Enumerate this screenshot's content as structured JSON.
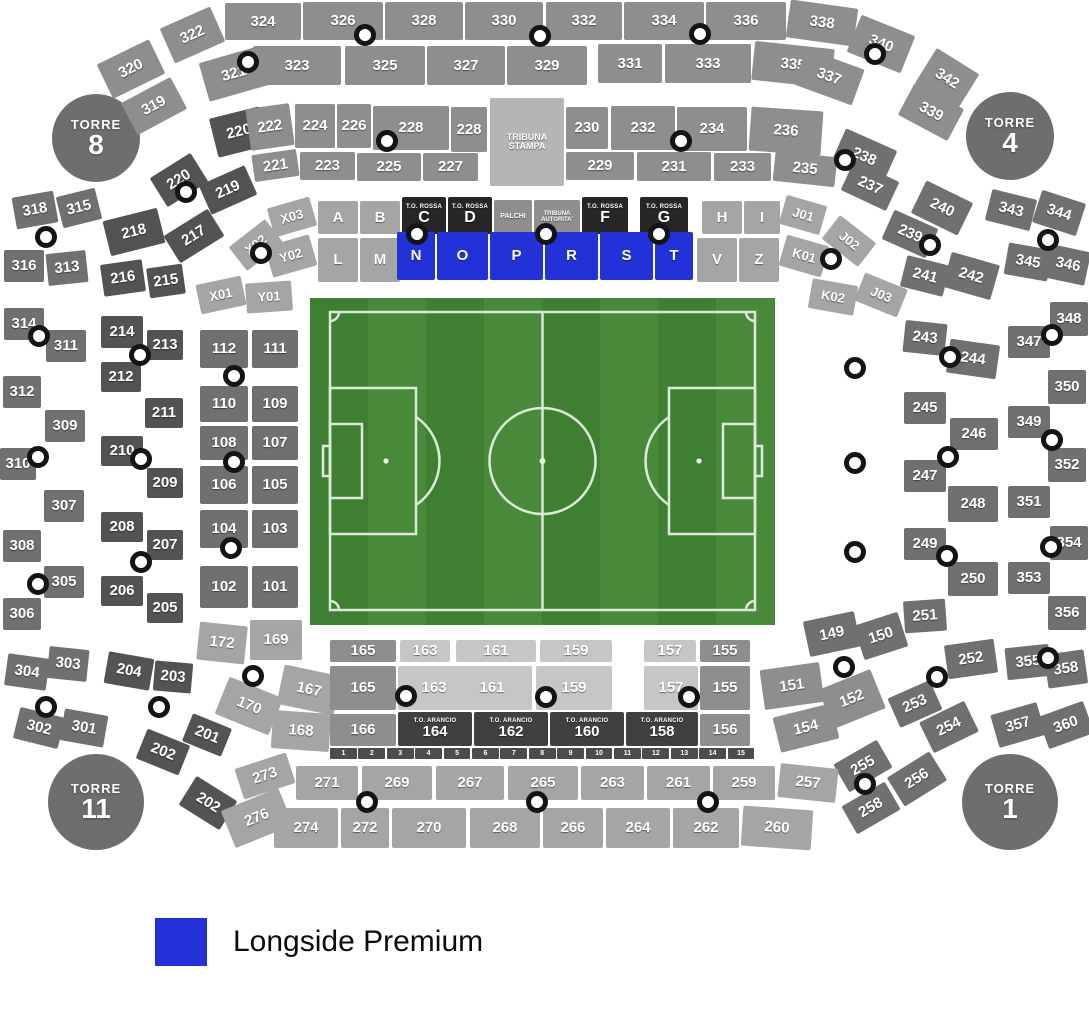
{
  "legend": {
    "label": "Longside Premium",
    "color": "#2232d8"
  },
  "towers": [
    {
      "word": "TORRE",
      "num": "8"
    },
    {
      "word": "TORRE",
      "num": "4"
    },
    {
      "word": "TORRE",
      "num": "11"
    },
    {
      "word": "TORRE",
      "num": "1"
    }
  ],
  "colors": {
    "a": "#8e8e8e",
    "b": "#707070",
    "c": "#535353",
    "d": "#a5a5a5",
    "e": "#c6c6c6",
    "f": "#262626",
    "g": "#404040",
    "ts": "#b5b5b5",
    "blue": "#2232d8"
  },
  "sections": [
    [
      "322",
      165,
      16,
      55,
      38,
      "a",
      -24
    ],
    [
      "324",
      225,
      3,
      76,
      37
    ],
    [
      "326",
      303,
      2,
      80,
      38
    ],
    [
      "328",
      385,
      2,
      78,
      38
    ],
    [
      "330",
      465,
      2,
      78,
      38
    ],
    [
      "332",
      546,
      2,
      76,
      38
    ],
    [
      "334",
      624,
      2,
      80,
      38
    ],
    [
      "336",
      706,
      2,
      80,
      38
    ],
    [
      "338",
      788,
      4,
      68,
      38,
      "a",
      8
    ],
    [
      "340",
      852,
      24,
      58,
      40,
      "a",
      22
    ],
    [
      "320",
      102,
      50,
      58,
      38,
      "a",
      -26
    ],
    [
      "321",
      203,
      54,
      62,
      40,
      "a",
      -16
    ],
    [
      "323",
      253,
      46,
      88,
      39
    ],
    [
      "325",
      345,
      46,
      80,
      39
    ],
    [
      "327",
      427,
      46,
      78,
      39
    ],
    [
      "329",
      507,
      46,
      80,
      39
    ],
    [
      "331",
      598,
      44,
      64,
      39
    ],
    [
      "333",
      665,
      44,
      86,
      39
    ],
    [
      "335",
      753,
      45,
      80,
      39,
      "a",
      6
    ],
    [
      "337",
      798,
      58,
      62,
      38,
      "a",
      20
    ],
    [
      "342",
      922,
      58,
      50,
      42,
      "a",
      32
    ],
    [
      "319",
      126,
      88,
      56,
      36,
      "a",
      -28
    ],
    [
      "339",
      903,
      94,
      56,
      36,
      "a",
      28
    ],
    [
      "220",
      213,
      112,
      52,
      40,
      "c",
      -14
    ],
    [
      "222",
      248,
      106,
      44,
      42,
      "a",
      -8
    ],
    [
      "224",
      295,
      104,
      40,
      44
    ],
    [
      "226",
      337,
      104,
      34,
      44
    ],
    [
      "228",
      373,
      106,
      76,
      44
    ],
    [
      "228",
      451,
      107,
      36,
      45
    ],
    [
      "TRIBUNA STAMPA",
      490,
      98,
      74,
      88,
      "ts",
      0,
      9
    ],
    [
      "230",
      566,
      107,
      42,
      42
    ],
    [
      "232",
      611,
      106,
      64,
      44
    ],
    [
      "234",
      677,
      107,
      70,
      44
    ],
    [
      "236",
      750,
      109,
      72,
      44,
      "a",
      4
    ],
    [
      "238",
      836,
      138,
      56,
      38,
      "b",
      24
    ],
    [
      "221",
      253,
      152,
      45,
      27,
      "a",
      -8
    ],
    [
      "223",
      300,
      152,
      55,
      28
    ],
    [
      "225",
      357,
      153,
      64,
      28
    ],
    [
      "227",
      423,
      153,
      55,
      28
    ],
    [
      "229",
      566,
      152,
      68,
      28
    ],
    [
      "231",
      637,
      152,
      74,
      29
    ],
    [
      "233",
      714,
      153,
      57,
      28
    ],
    [
      "235",
      774,
      154,
      62,
      30,
      "a",
      6
    ],
    [
      "237",
      845,
      170,
      50,
      32,
      "b",
      25
    ],
    [
      "220",
      155,
      163,
      48,
      34,
      "c",
      -32
    ],
    [
      "219",
      203,
      174,
      50,
      32,
      "c",
      -24
    ],
    [
      "217",
      168,
      220,
      52,
      32,
      "c",
      -32
    ],
    [
      "218",
      106,
      214,
      56,
      36,
      "c",
      -14
    ],
    [
      "216",
      102,
      262,
      42,
      32,
      "c",
      -8
    ],
    [
      "215",
      148,
      266,
      36,
      30,
      "c",
      -8
    ],
    [
      "214",
      101,
      316,
      42,
      32,
      "c"
    ],
    [
      "213",
      147,
      330,
      36,
      30,
      "c"
    ],
    [
      "212",
      101,
      362,
      40,
      30,
      "c"
    ],
    [
      "211",
      145,
      398,
      38,
      30,
      "c"
    ],
    [
      "210",
      101,
      436,
      42,
      30,
      "c"
    ],
    [
      "209",
      147,
      468,
      36,
      30,
      "c"
    ],
    [
      "208",
      101,
      512,
      42,
      30,
      "c"
    ],
    [
      "207",
      147,
      530,
      36,
      30,
      "c"
    ],
    [
      "206",
      101,
      576,
      42,
      30,
      "c"
    ],
    [
      "205",
      147,
      593,
      36,
      30,
      "c"
    ],
    [
      "204",
      106,
      655,
      46,
      32,
      "c",
      10
    ],
    [
      "203",
      154,
      662,
      38,
      30,
      "c",
      5
    ],
    [
      "202",
      140,
      736,
      46,
      32,
      "c",
      22
    ],
    [
      "201",
      186,
      720,
      42,
      30,
      "c",
      22
    ],
    [
      "202",
      184,
      786,
      48,
      34,
      "c",
      32
    ],
    [
      "318",
      14,
      194,
      42,
      32,
      "b",
      -10
    ],
    [
      "315",
      59,
      192,
      40,
      32,
      "b",
      -14
    ],
    [
      "316",
      4,
      250,
      40,
      32,
      "b"
    ],
    [
      "313",
      47,
      252,
      40,
      32,
      "b",
      -6
    ],
    [
      "314",
      4,
      308,
      40,
      32,
      "b"
    ],
    [
      "311",
      46,
      330,
      40,
      32,
      "b"
    ],
    [
      "312",
      3,
      376,
      38,
      32,
      "b"
    ],
    [
      "309",
      45,
      410,
      40,
      32,
      "b"
    ],
    [
      "310",
      0,
      448,
      36,
      32,
      "b"
    ],
    [
      "307",
      44,
      490,
      40,
      32,
      "b"
    ],
    [
      "308",
      3,
      530,
      38,
      32,
      "b"
    ],
    [
      "305",
      44,
      566,
      40,
      32,
      "b"
    ],
    [
      "306",
      3,
      598,
      38,
      32,
      "b"
    ],
    [
      "303",
      48,
      648,
      40,
      32,
      "b",
      6
    ],
    [
      "304",
      6,
      656,
      42,
      32,
      "b",
      8
    ],
    [
      "302",
      16,
      712,
      46,
      32,
      "b",
      14
    ],
    [
      "301",
      62,
      712,
      44,
      32,
      "b",
      10
    ],
    [
      "112",
      200,
      330,
      48,
      38,
      "b"
    ],
    [
      "111",
      252,
      330,
      46,
      38,
      "b"
    ],
    [
      "110",
      200,
      386,
      48,
      36,
      "b"
    ],
    [
      "109",
      252,
      386,
      46,
      36,
      "b"
    ],
    [
      "108",
      200,
      426,
      48,
      34,
      "b"
    ],
    [
      "107",
      252,
      426,
      46,
      34,
      "b"
    ],
    [
      "106",
      200,
      466,
      48,
      38,
      "b"
    ],
    [
      "105",
      252,
      466,
      46,
      38,
      "b"
    ],
    [
      "104",
      200,
      510,
      48,
      38,
      "b"
    ],
    [
      "103",
      252,
      510,
      46,
      38,
      "b"
    ],
    [
      "102",
      200,
      566,
      48,
      42,
      "b"
    ],
    [
      "101",
      252,
      566,
      46,
      42,
      "b"
    ],
    [
      "172",
      198,
      624,
      48,
      38,
      "d",
      6
    ],
    [
      "169",
      250,
      620,
      52,
      40,
      "d"
    ],
    [
      "170",
      220,
      686,
      58,
      40,
      "d",
      22
    ],
    [
      "167",
      280,
      670,
      58,
      40,
      "d",
      12
    ],
    [
      "168",
      272,
      712,
      58,
      38,
      "d",
      4
    ],
    [
      "X03",
      270,
      202,
      44,
      30,
      "d",
      -16,
      13
    ],
    [
      "A",
      318,
      201,
      40,
      33,
      "d"
    ],
    [
      "B",
      360,
      201,
      40,
      33,
      "d"
    ],
    [
      "C",
      402,
      197,
      44,
      37,
      "f",
      0,
      16,
      "T.O. ROSSA"
    ],
    [
      "D",
      448,
      197,
      44,
      37,
      "f",
      0,
      16,
      "T.O. ROSSA"
    ],
    [
      "PALCHI",
      494,
      200,
      38,
      34,
      "a",
      0,
      7
    ],
    [
      "TRIBUNA AUTORITA'",
      534,
      200,
      46,
      34,
      "a",
      0,
      6
    ],
    [
      "F",
      582,
      197,
      46,
      37,
      "f",
      0,
      16,
      "T.O. ROSSA"
    ],
    [
      "G",
      640,
      197,
      48,
      37,
      "f",
      0,
      16,
      "T.O. ROSSA"
    ],
    [
      "H",
      702,
      201,
      40,
      33,
      "d"
    ],
    [
      "I",
      744,
      201,
      36,
      33,
      "d"
    ],
    [
      "J01",
      782,
      200,
      42,
      30,
      "d",
      16,
      13
    ],
    [
      "Y02",
      268,
      240,
      46,
      32,
      "d",
      -16,
      13
    ],
    [
      "L",
      318,
      238,
      40,
      44,
      "d"
    ],
    [
      "M",
      360,
      238,
      40,
      44,
      "d"
    ],
    [
      "N",
      397,
      232,
      38,
      48,
      "blue"
    ],
    [
      "O",
      437,
      232,
      51,
      48,
      "blue"
    ],
    [
      "P",
      490,
      232,
      53,
      48,
      "blue"
    ],
    [
      "R",
      545,
      232,
      53,
      48,
      "blue"
    ],
    [
      "S",
      600,
      232,
      53,
      48,
      "blue"
    ],
    [
      "T",
      655,
      232,
      38,
      48,
      "blue"
    ],
    [
      "V",
      697,
      238,
      40,
      44,
      "d"
    ],
    [
      "Z",
      739,
      238,
      40,
      44,
      "d"
    ],
    [
      "K01",
      782,
      240,
      44,
      32,
      "d",
      16,
      13
    ],
    [
      "X02",
      233,
      230,
      46,
      30,
      "d",
      -38,
      13
    ],
    [
      "X01",
      198,
      280,
      46,
      30,
      "d",
      -12,
      13
    ],
    [
      "Y01",
      246,
      282,
      46,
      30,
      "d",
      -4,
      13
    ],
    [
      "J02",
      826,
      226,
      46,
      30,
      "d",
      38,
      13
    ],
    [
      "K02",
      810,
      282,
      46,
      30,
      "d",
      10,
      13
    ],
    [
      "J03",
      858,
      280,
      46,
      30,
      "d",
      22,
      13
    ],
    [
      "239",
      886,
      218,
      48,
      32,
      "b",
      24
    ],
    [
      "240",
      916,
      190,
      52,
      36,
      "b",
      26
    ],
    [
      "241",
      903,
      260,
      44,
      32,
      "b",
      14
    ],
    [
      "242",
      946,
      258,
      50,
      36,
      "b",
      16
    ],
    [
      "243",
      904,
      322,
      42,
      32,
      "b",
      6
    ],
    [
      "244",
      948,
      342,
      50,
      34,
      "b",
      8
    ],
    [
      "245",
      904,
      392,
      42,
      32,
      "b"
    ],
    [
      "246",
      950,
      418,
      48,
      32,
      "b"
    ],
    [
      "247",
      904,
      460,
      42,
      32,
      "b"
    ],
    [
      "248",
      948,
      486,
      50,
      36,
      "b"
    ],
    [
      "249",
      904,
      528,
      42,
      32,
      "b"
    ],
    [
      "250",
      948,
      562,
      50,
      34,
      "b"
    ],
    [
      "251",
      904,
      600,
      42,
      32,
      "b",
      -4
    ],
    [
      "252",
      946,
      642,
      50,
      34,
      "b",
      -8
    ],
    [
      "253",
      892,
      688,
      46,
      32,
      "b",
      -24
    ],
    [
      "254",
      924,
      710,
      50,
      34,
      "b",
      -26
    ],
    [
      "255",
      838,
      750,
      50,
      32,
      "b",
      -30
    ],
    [
      "256",
      892,
      762,
      50,
      34,
      "b",
      -32
    ],
    [
      "258",
      846,
      792,
      50,
      32,
      "b",
      -30
    ],
    [
      "343",
      988,
      194,
      46,
      32,
      "b",
      14
    ],
    [
      "344",
      1036,
      196,
      46,
      34,
      "b",
      18
    ],
    [
      "345",
      1006,
      246,
      44,
      32,
      "b",
      10
    ],
    [
      "346",
      1048,
      248,
      40,
      34,
      "b",
      12
    ],
    [
      "348",
      1050,
      302,
      38,
      34,
      "b"
    ],
    [
      "347",
      1008,
      326,
      42,
      32,
      "b"
    ],
    [
      "350",
      1048,
      370,
      38,
      34,
      "b"
    ],
    [
      "349",
      1008,
      406,
      42,
      32,
      "b"
    ],
    [
      "352",
      1048,
      448,
      38,
      34,
      "b"
    ],
    [
      "351",
      1008,
      486,
      42,
      32,
      "b"
    ],
    [
      "354",
      1050,
      526,
      38,
      34,
      "b"
    ],
    [
      "353",
      1008,
      562,
      42,
      32,
      "b"
    ],
    [
      "356",
      1048,
      596,
      38,
      34,
      "b"
    ],
    [
      "355",
      1006,
      646,
      44,
      32,
      "b",
      -6
    ],
    [
      "358",
      1046,
      652,
      40,
      34,
      "b",
      -8
    ],
    [
      "357",
      994,
      708,
      48,
      34,
      "b",
      -16
    ],
    [
      "360",
      1042,
      708,
      48,
      34,
      "b",
      -20
    ],
    [
      "165",
      330,
      640,
      66,
      22,
      "a"
    ],
    [
      "163",
      400,
      640,
      50,
      22,
      "e"
    ],
    [
      "161",
      456,
      640,
      80,
      22,
      "e"
    ],
    [
      "159",
      540,
      640,
      72,
      22,
      "e"
    ],
    [
      "157",
      644,
      640,
      52,
      22,
      "e"
    ],
    [
      "155",
      700,
      640,
      50,
      22,
      "a"
    ],
    [
      "165",
      330,
      666,
      66,
      44,
      "a"
    ],
    [
      "163",
      398,
      666,
      72,
      44,
      "e"
    ],
    [
      "161",
      452,
      666,
      80,
      44,
      "e"
    ],
    [
      "159",
      536,
      666,
      76,
      44,
      "e"
    ],
    [
      "157",
      644,
      666,
      54,
      44,
      "e"
    ],
    [
      "155",
      700,
      666,
      50,
      44,
      "a"
    ],
    [
      "166",
      330,
      714,
      66,
      32,
      "a"
    ],
    [
      "164",
      398,
      712,
      74,
      34,
      "g",
      0,
      15,
      "T.O. ARANCIO"
    ],
    [
      "162",
      474,
      712,
      74,
      34,
      "g",
      0,
      15,
      "T.O. ARANCIO"
    ],
    [
      "160",
      550,
      712,
      74,
      34,
      "g",
      0,
      15,
      "T.O. ARANCIO"
    ],
    [
      "158",
      626,
      712,
      72,
      34,
      "g",
      0,
      15,
      "T.O. ARANCIO"
    ],
    [
      "156",
      700,
      714,
      50,
      32,
      "a"
    ],
    [
      "151",
      762,
      666,
      60,
      40,
      "a",
      -8
    ],
    [
      "152",
      824,
      678,
      56,
      42,
      "a",
      -22
    ],
    [
      "154",
      776,
      710,
      60,
      36,
      "a",
      -14
    ],
    [
      "149",
      806,
      616,
      52,
      36,
      "b",
      -12
    ],
    [
      "150",
      858,
      618,
      46,
      36,
      "b",
      -18
    ],
    [
      "273",
      238,
      760,
      54,
      32,
      "d",
      -18
    ],
    [
      "271",
      296,
      766,
      62,
      34,
      "d"
    ],
    [
      "269",
      362,
      766,
      70,
      34,
      "d"
    ],
    [
      "267",
      436,
      766,
      68,
      34,
      "d"
    ],
    [
      "265",
      508,
      766,
      70,
      34,
      "d"
    ],
    [
      "263",
      581,
      766,
      63,
      34,
      "d"
    ],
    [
      "261",
      647,
      766,
      63,
      34,
      "d"
    ],
    [
      "259",
      713,
      766,
      62,
      34,
      "d"
    ],
    [
      "257",
      779,
      766,
      58,
      34,
      "d",
      6
    ],
    [
      "276",
      226,
      798,
      62,
      40,
      "d",
      -22
    ],
    [
      "274",
      274,
      808,
      64,
      40,
      "d"
    ],
    [
      "272",
      341,
      808,
      48,
      40,
      "d"
    ],
    [
      "270",
      392,
      808,
      74,
      40,
      "d"
    ],
    [
      "268",
      470,
      808,
      70,
      40,
      "d"
    ],
    [
      "266",
      543,
      808,
      60,
      40,
      "d"
    ],
    [
      "264",
      606,
      808,
      64,
      40,
      "d"
    ],
    [
      "262",
      673,
      808,
      66,
      40,
      "d"
    ],
    [
      "260",
      742,
      808,
      70,
      40,
      "d",
      4
    ]
  ],
  "strip": {
    "x": 330,
    "y": 748,
    "w": 426,
    "h": 11,
    "labels": [
      "1",
      "2",
      "3",
      "4",
      "5",
      "6",
      "7",
      "8",
      "9",
      "10",
      "11",
      "12",
      "13",
      "14",
      "15"
    ]
  },
  "dots": [
    [
      365,
      35
    ],
    [
      540,
      36
    ],
    [
      700,
      34
    ],
    [
      875,
      54
    ],
    [
      248,
      62
    ],
    [
      387,
      141
    ],
    [
      681,
      141
    ],
    [
      845,
      160
    ],
    [
      186,
      192
    ],
    [
      417,
      234
    ],
    [
      546,
      234
    ],
    [
      659,
      234
    ],
    [
      261,
      253
    ],
    [
      831,
      259
    ],
    [
      930,
      245
    ],
    [
      1048,
      240
    ],
    [
      46,
      237
    ],
    [
      39,
      336
    ],
    [
      140,
      355
    ],
    [
      38,
      457
    ],
    [
      141,
      459
    ],
    [
      141,
      562
    ],
    [
      38,
      584
    ],
    [
      46,
      707
    ],
    [
      159,
      707
    ],
    [
      234,
      376
    ],
    [
      234,
      462
    ],
    [
      231,
      548
    ],
    [
      253,
      676
    ],
    [
      406,
      696
    ],
    [
      546,
      697
    ],
    [
      689,
      697
    ],
    [
      844,
      667
    ],
    [
      937,
      677
    ],
    [
      855,
      368
    ],
    [
      855,
      463
    ],
    [
      855,
      552
    ],
    [
      1052,
      335
    ],
    [
      950,
      357
    ],
    [
      1052,
      440
    ],
    [
      948,
      457
    ],
    [
      947,
      556
    ],
    [
      1051,
      547
    ],
    [
      1048,
      658
    ],
    [
      367,
      802
    ],
    [
      537,
      802
    ],
    [
      708,
      802
    ],
    [
      865,
      784
    ]
  ]
}
